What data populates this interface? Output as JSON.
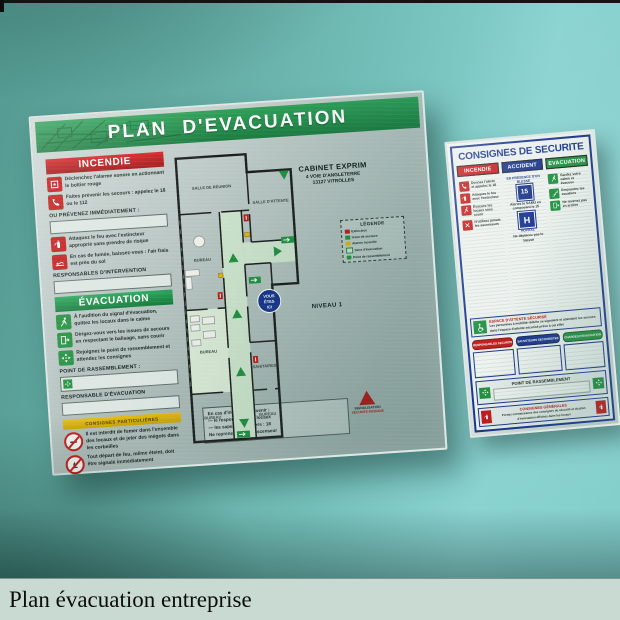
{
  "palette": {
    "wall_teal": "#74bfb9",
    "sign_green": "#27954f",
    "sign_red": "#c01818",
    "sign_blue": "#16338a",
    "sign_yellow": "#d7af0e",
    "metal_gray": "#b4c2bf",
    "caption_bg": "#c8dad2"
  },
  "caption": {
    "text": "Plan évacuation entreprise"
  },
  "left_sign": {
    "title": "PLAN D'EVACUATION",
    "company": {
      "name": "CABINET EXPRIM",
      "address1": "4 VOIE D'ANGLETERRE",
      "address2": "13127 VITROLLES"
    },
    "level_label": "NIVEAU 1",
    "incendie": {
      "header": "INCENDIE",
      "item1": "Déclenchez l'alarme sonore en actionnant le boîtier rouge",
      "item2": "Faites prévenir les secours : appelez le 18 ou le 112",
      "notice": "OU PRÉVENEZ IMMÉDIATEMENT :",
      "item3": "Attaquez le feu avec l'extincteur approprié sans prendre de risque",
      "item4": "En cas de fumée, baissez-vous : l'air frais est près du sol",
      "responders_label": "RESPONSABLES D'INTERVENTION"
    },
    "evacuation": {
      "header": "ÉVACUATION",
      "item1": "À l'audition du signal d'évacuation, quittez les locaux dans le calme",
      "item2": "Dirigez-vous vers les issues de secours en respectant le balisage, sans courir",
      "item3": "Rejoignez le point de rassemblement et attendez les consignes",
      "assembly_label": "POINT DE RASSEMBLEMENT :",
      "leader_label": "RESPONSABLE D'ÉVACUATION"
    },
    "notice_band": "CONSIGNES PARTICULIÈRES",
    "prohibitions": {
      "item1": "Il est interdit de fumer dans l'ensemble des locaux et de jeter des mégots dans les corbeilles",
      "item2": "Tout départ de feu, même éteint, doit être signalé immédiatement"
    },
    "note_box": {
      "line1": "En cas d'incendie, prévenir :",
      "line2": "— le responsable des locaux",
      "line3": "— les sapeurs-pompiers : 18",
      "line4": "Ne reprenez jamais l'ascenseur"
    },
    "legend": {
      "title": "LÉGENDE",
      "row1": "Extincteur",
      "row2": "Issue de secours",
      "row3": "Alarme incendie",
      "row4": "Sens d'évacuation",
      "row5": "Point de rassemblement"
    },
    "plan": {
      "room_meeting": "SALLE DE RÉUNION",
      "room_waiting": "SALLE D'ATTENTE",
      "room_office1": "BUREAU",
      "room_office2": "BUREAU",
      "room_sanitary": "SANITAIRES",
      "room_office3": "BUREAU",
      "room_office4": "BUREAU",
      "you_are_here_1": "VOUS",
      "you_are_here_2": "ÊTES",
      "you_are_here_3": "ICI"
    },
    "logo": {
      "line1": "SIGNALISATION",
      "line2": "SÉCURITÉ INCENDIE"
    }
  },
  "right_sign": {
    "title": "CONSIGNES DE SECURITE",
    "col_fire": {
      "header": "INCENDIE",
      "item1": "Donnez l'alerte et appelez le 18",
      "item2": "Attaquez le feu avec l'extincteur",
      "item3": "Évacuez les locaux sans courir",
      "item4": "N'utilisez jamais les ascenseurs"
    },
    "col_accident": {
      "header": "ACCIDENT",
      "subheader": "EN PRÉSENCE D'UN BLESSÉ",
      "badge15": "15",
      "item1": "Alertez le SAMU en composant le 15",
      "hospital_h": "H",
      "hospital_label": "HÔPITAL",
      "item2": "Ne déplacez pas le blessé"
    },
    "col_evac": {
      "header": "EVACUATION",
      "item1": "Gardez votre calme et évacuez",
      "item2": "Empruntez les escaliers",
      "item3": "Ne revenez pas en arrière"
    },
    "secured_area": {
      "title": "ESPACE D'ATTENTE SÉCURISÉ",
      "text": "Les personnes à mobilité réduite se signalent et attendent les secours dans l'espace d'attente sécurisé prévu à cet effet"
    },
    "pills": {
      "pill1": "RESPONSABLES SECURITE",
      "pill2": "SAUVETEURS SECOURISTES",
      "pill3": "CHARGES D'EVACUATION"
    },
    "assembly": {
      "title": "POINT DE RASSEMBLEMENT"
    },
    "general": {
      "title": "CONSIGNES GÉNÉRALES",
      "text": "Prenez connaissance des consignes de sécurité et du plan d'évacuation affichés dans les locaux"
    }
  }
}
